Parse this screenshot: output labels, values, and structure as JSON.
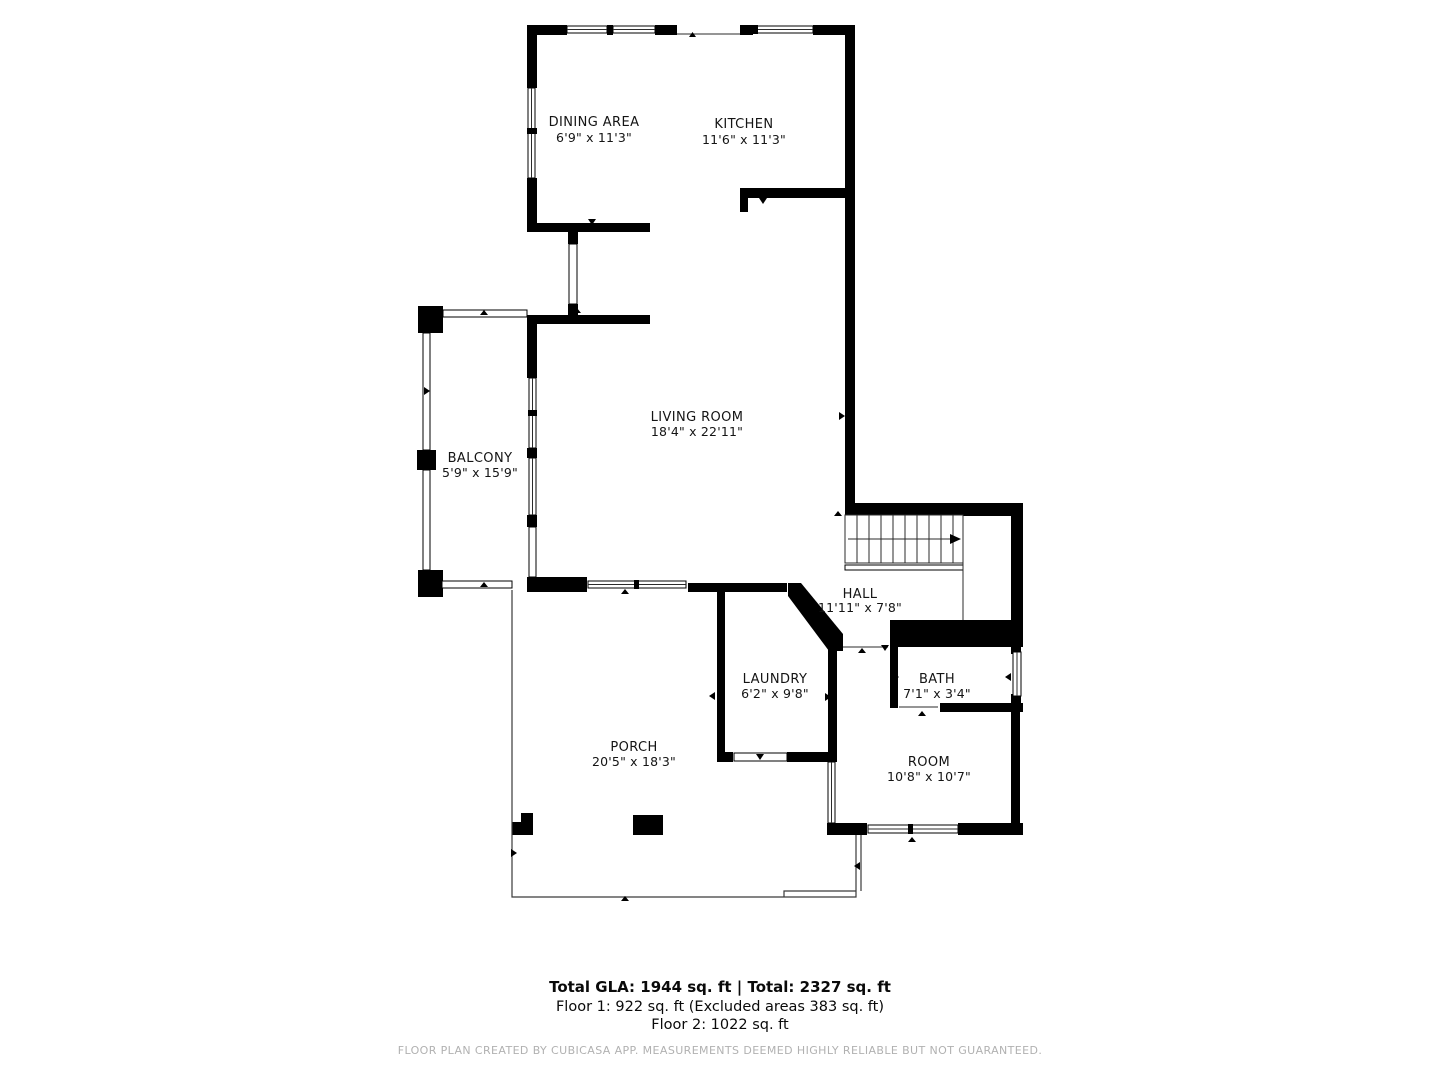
{
  "colors": {
    "wall": "#000000",
    "thin_line": "#2b2b2b",
    "background": "#ffffff",
    "footer_text": "#b1b1b1"
  },
  "rooms": [
    {
      "id": "dining",
      "name": "DINING AREA",
      "dims": "6'9\" x 11'3\""
    },
    {
      "id": "kitchen",
      "name": "KITCHEN",
      "dims": "11'6\" x 11'3\""
    },
    {
      "id": "living",
      "name": "LIVING ROOM",
      "dims": "18'4\" x 22'11\""
    },
    {
      "id": "balcony",
      "name": "BALCONY",
      "dims": "5'9\" x 15'9\""
    },
    {
      "id": "hall",
      "name": "HALL",
      "dims": "11'11\" x 7'8\""
    },
    {
      "id": "laundry",
      "name": "LAUNDRY",
      "dims": "6'2\" x 9'8\""
    },
    {
      "id": "bath",
      "name": "BATH",
      "dims": "7'1\" x 3'4\""
    },
    {
      "id": "room",
      "name": "ROOM",
      "dims": "10'8\" x 10'7\""
    },
    {
      "id": "porch",
      "name": "PORCH",
      "dims": "20'5\" x 18'3\""
    }
  ],
  "summary": {
    "total_line": "Total GLA: 1944 sq. ft | Total: 2327 sq. ft",
    "floor1_line": "Floor 1: 922 sq. ft (Excluded areas 383 sq. ft)",
    "floor2_line": "Floor 2: 1022 sq. ft"
  },
  "footer": {
    "disclaimer": "FLOOR PLAN CREATED BY CUBICASA APP. MEASUREMENTS DEEMED HIGHLY RELIABLE BUT NOT GUARANTEED."
  }
}
